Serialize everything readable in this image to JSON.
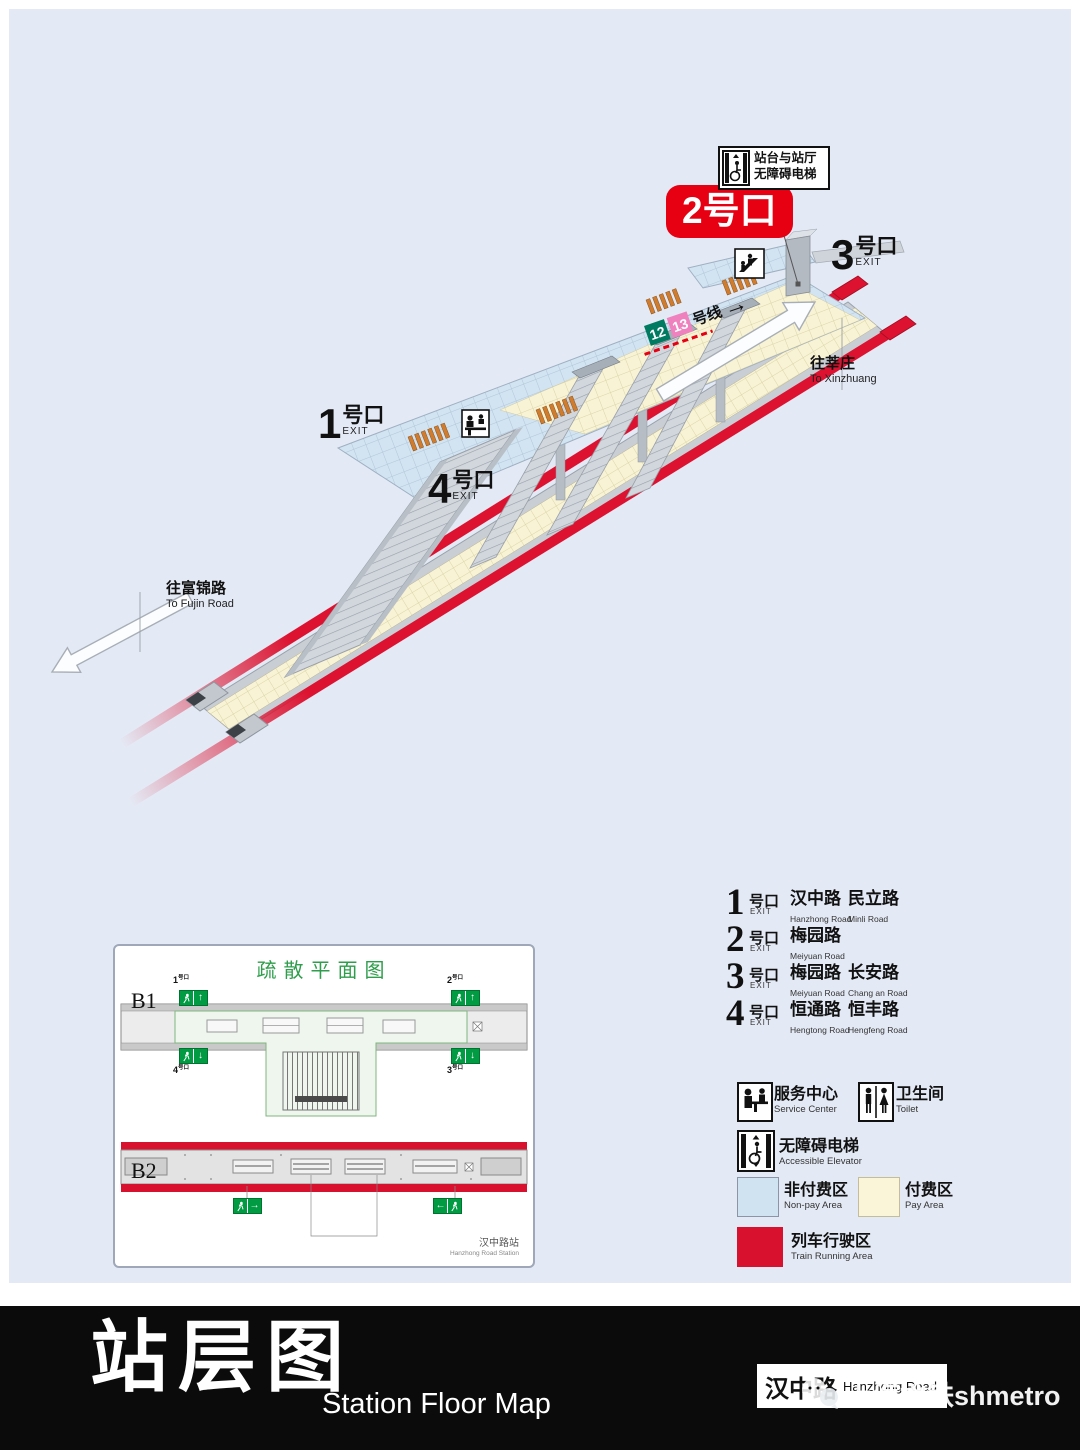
{
  "map": {
    "exit1_num": "1",
    "exit3_num": "3",
    "exit4_num": "4",
    "exit_suffix": "号口",
    "exit_en": "EXIT",
    "exit2_badge": "2号口",
    "elevator_callout_line1": "站台与站厅",
    "elevator_callout_line2": "无障碍电梯",
    "line_sign": {
      "line12": "12",
      "line13": "13",
      "suffix": "号线",
      "arrow": "→"
    },
    "to_xinzhuang_zh": "往莘庄",
    "to_xinzhuang_en": "To Xinzhuang",
    "to_fujin_zh": "往富锦路",
    "to_fujin_en": "To Fujin Road"
  },
  "evac": {
    "title": "疏散平面图",
    "level_b1": "B1",
    "level_b2": "B2",
    "e1": "1",
    "e2": "2",
    "e3": "3",
    "e4": "4",
    "suffix": "号口",
    "arrow_up": "↑",
    "arrow_down": "↓",
    "arrow_left": "←",
    "arrow_right": "→",
    "station_zh": "汉中路站",
    "station_en": "Hanzhong Road Station"
  },
  "exit_list": {
    "suffix": "号口",
    "exit_en": "EXIT",
    "rows": [
      {
        "num": "1",
        "road1_zh": "汉中路",
        "road1_en": "Hanzhong Road",
        "road2_zh": "民立路",
        "road2_en": "Minli Road"
      },
      {
        "num": "2",
        "road1_zh": "梅园路",
        "road1_en": "Meiyuan Road",
        "road2_zh": "",
        "road2_en": ""
      },
      {
        "num": "3",
        "road1_zh": "梅园路",
        "road1_en": "Meiyuan Road",
        "road2_zh": "长安路",
        "road2_en": "Chang an Road"
      },
      {
        "num": "4",
        "road1_zh": "恒通路",
        "road1_en": "Hengtong Road",
        "road2_zh": "恒丰路",
        "road2_en": "Hengfeng Road"
      }
    ]
  },
  "legend": {
    "service_zh": "服务中心",
    "service_en": "Service Center",
    "toilet_zh": "卫生间",
    "toilet_en": "Toilet",
    "elevator_zh": "无障碍电梯",
    "elevator_en": "Accessible Elevator",
    "nonpay_zh": "非付费区",
    "nonpay_en": "Non-pay Area",
    "pay_zh": "付费区",
    "pay_en": "Pay Area",
    "train_zh": "列车行驶区",
    "train_en": "Train Running  Area"
  },
  "footer": {
    "title_zh": "站层图",
    "title_en": "Station Floor Map",
    "station_zh": "汉中路",
    "station_en": "Hanzhong Road",
    "watermark": "上海地铁shmetro"
  },
  "colors": {
    "background": "#e4eaf5",
    "nonpay": "#cfe3f0",
    "pay": "#faf5d9",
    "train_red": "#d8122e",
    "exit_badge_red": "#e60012",
    "line12_green": "#007a61",
    "line13_pink": "#ef82be",
    "exit_sign_green": "#009b42"
  }
}
